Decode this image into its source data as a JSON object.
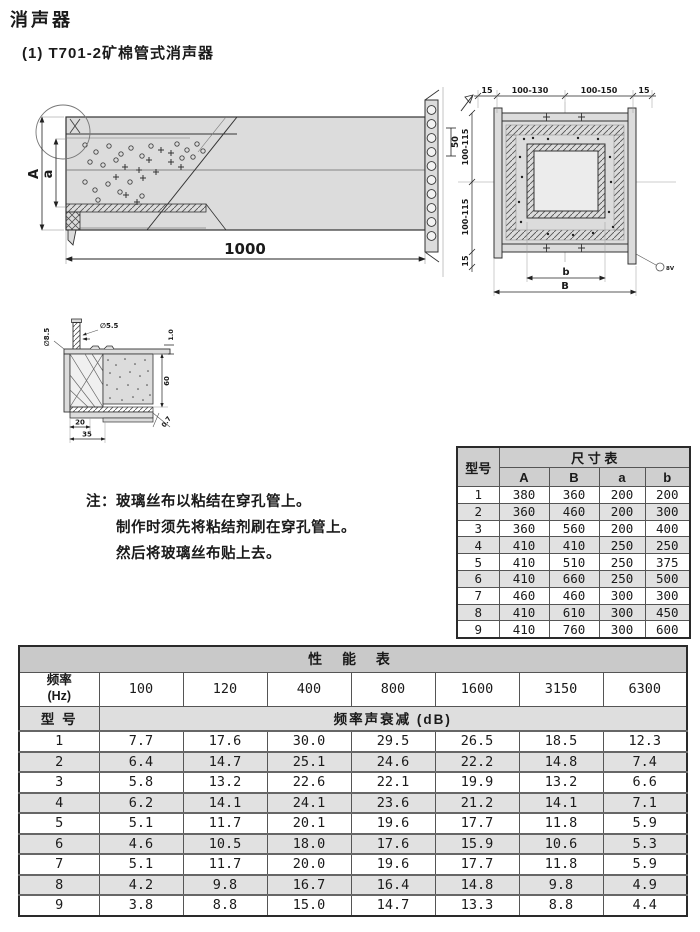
{
  "page": {
    "title": "消声器",
    "subtitle": "(1) T701-2矿棉管式消声器"
  },
  "side_view": {
    "label_A": "A",
    "label_a": "a",
    "dim_length": "1000",
    "dim_hole_spacing": "50"
  },
  "cross_section": {
    "dim_top": [
      "15",
      "100-130",
      "100-150",
      "15"
    ],
    "dim_left": [
      "100-115",
      "100-115",
      "15"
    ],
    "dim_b": "b",
    "dim_B": "B",
    "callout": "8V"
  },
  "detail_view": {
    "dim_phi_rivet": "∅8.5",
    "dim_phi_hole": "∅5.5",
    "dim_sheet": "1.0",
    "dim_depth": "60",
    "dim_plate": "0.7",
    "dim_20": "20",
    "dim_35": "35"
  },
  "note": {
    "prefix": "注：",
    "lines": [
      "玻璃丝布以粘结在穿孔管上。",
      "制作时须先将粘结剂刷在穿孔管上。",
      "然后将玻璃丝布贴上去。"
    ]
  },
  "size_table": {
    "title": "尺 寸 表",
    "model_header": "型号",
    "columns": [
      "A",
      "B",
      "a",
      "b"
    ],
    "rows": [
      {
        "model": "1",
        "values": [
          "380",
          "360",
          "200",
          "200"
        ]
      },
      {
        "model": "2",
        "values": [
          "360",
          "460",
          "200",
          "300"
        ]
      },
      {
        "model": "3",
        "values": [
          "360",
          "560",
          "200",
          "400"
        ]
      },
      {
        "model": "4",
        "values": [
          "410",
          "410",
          "250",
          "250"
        ]
      },
      {
        "model": "5",
        "values": [
          "410",
          "510",
          "250",
          "375"
        ]
      },
      {
        "model": "6",
        "values": [
          "410",
          "660",
          "250",
          "500"
        ]
      },
      {
        "model": "7",
        "values": [
          "460",
          "460",
          "300",
          "300"
        ]
      },
      {
        "model": "8",
        "values": [
          "410",
          "610",
          "300",
          "450"
        ]
      },
      {
        "model": "9",
        "values": [
          "410",
          "760",
          "300",
          "600"
        ]
      }
    ]
  },
  "performance_table": {
    "title": "性  能  表",
    "freq_header": "频率\n(Hz)",
    "frequencies": [
      "100",
      "120",
      "400",
      "800",
      "1600",
      "3150",
      "6300"
    ],
    "model_header": "型 号",
    "attenuation_header": "频率声衰减 (dB)",
    "rows": [
      {
        "model": "1",
        "values": [
          "7.7",
          "17.6",
          "30.0",
          "29.5",
          "26.5",
          "18.5",
          "12.3"
        ]
      },
      {
        "model": "2",
        "values": [
          "6.4",
          "14.7",
          "25.1",
          "24.6",
          "22.2",
          "14.8",
          "7.4"
        ]
      },
      {
        "model": "3",
        "values": [
          "5.8",
          "13.2",
          "22.6",
          "22.1",
          "19.9",
          "13.2",
          "6.6"
        ]
      },
      {
        "model": "4",
        "values": [
          "6.2",
          "14.1",
          "24.1",
          "23.6",
          "21.2",
          "14.1",
          "7.1"
        ]
      },
      {
        "model": "5",
        "values": [
          "5.1",
          "11.7",
          "20.1",
          "19.6",
          "17.7",
          "11.8",
          "5.9"
        ]
      },
      {
        "model": "6",
        "values": [
          "4.6",
          "10.5",
          "18.0",
          "17.6",
          "15.9",
          "10.6",
          "5.3"
        ]
      },
      {
        "model": "7",
        "values": [
          "5.1",
          "11.7",
          "20.0",
          "19.6",
          "17.7",
          "11.8",
          "5.9"
        ]
      },
      {
        "model": "8",
        "values": [
          "4.2",
          "9.8",
          "16.7",
          "16.4",
          "14.8",
          "9.8",
          "4.9"
        ]
      },
      {
        "model": "9",
        "values": [
          "3.8",
          "8.8",
          "15.0",
          "14.7",
          "13.3",
          "8.8",
          "4.4"
        ]
      }
    ]
  }
}
